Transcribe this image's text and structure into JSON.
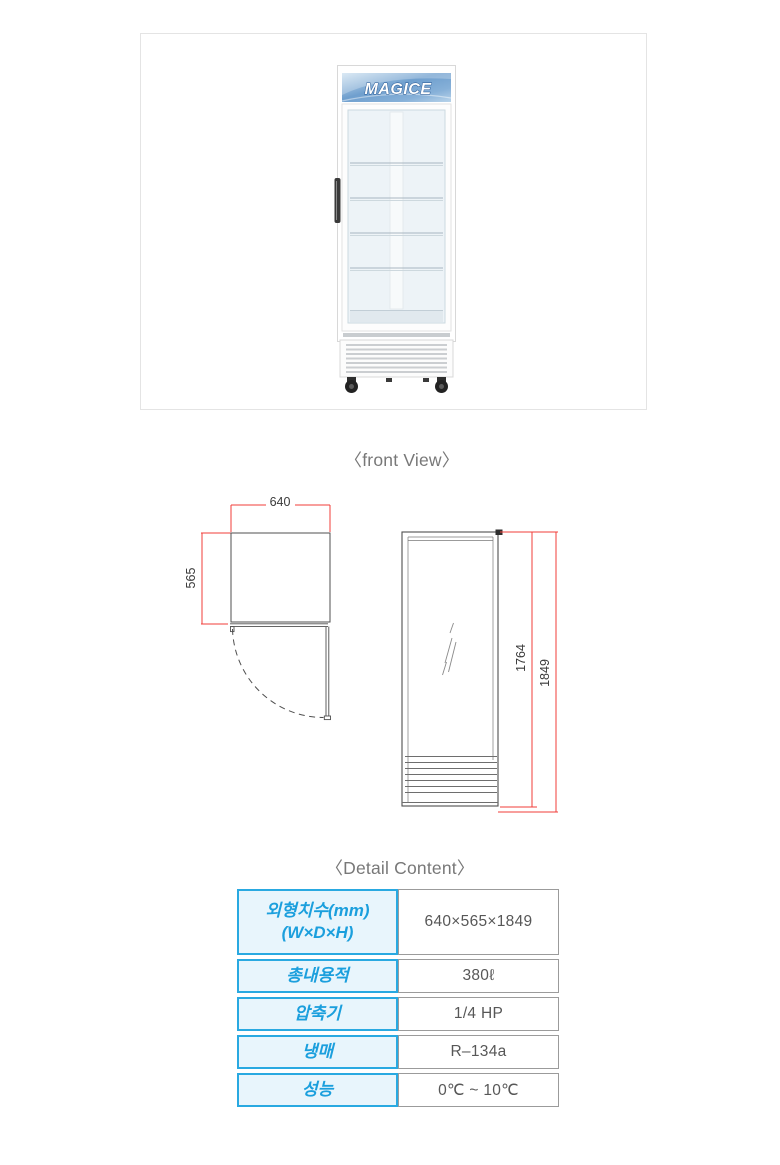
{
  "product_photo": {
    "brand": "MAGICE"
  },
  "headings": {
    "front_view": "〈front View〉",
    "detail_content": "〈Detail Content〉"
  },
  "drawings": {
    "top_view": {
      "width": "640",
      "depth": "565"
    },
    "side_view": {
      "inner_height": "1764",
      "total_height": "1849"
    },
    "colors": {
      "dimension_red": "#f03d3a",
      "line_gray": "#4f4f4f"
    }
  },
  "spec_table": {
    "colors": {
      "accent": "#29a9e1",
      "accent_bg": "#e8f5fc",
      "value_border": "#9b9b9b",
      "value_text": "#575757"
    },
    "rows": [
      {
        "label": "외형치수(mm)",
        "label2": "(W×D×H)",
        "value": "640×565×1849"
      },
      {
        "label": "총내용적",
        "value": "380ℓ"
      },
      {
        "label": "압축기",
        "value": "1/4 HP"
      },
      {
        "label": "냉매",
        "value": "R–134a"
      },
      {
        "label": "성능",
        "value": "0℃ ~ 10℃"
      }
    ]
  }
}
